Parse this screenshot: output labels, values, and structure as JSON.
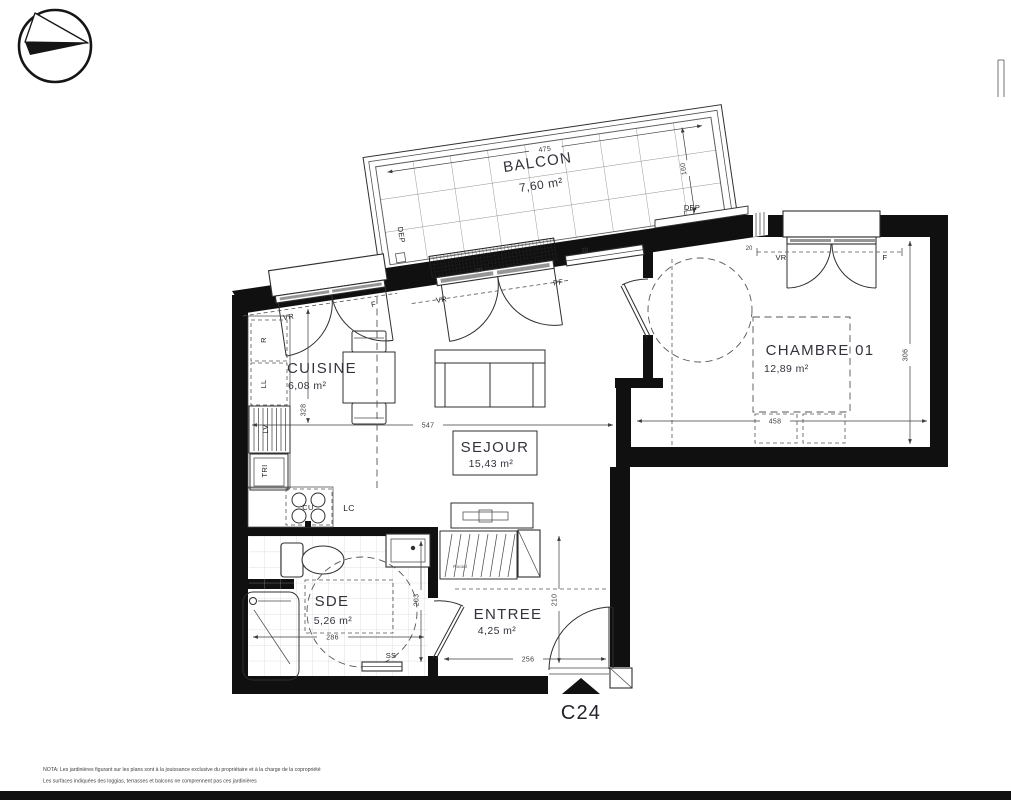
{
  "unit": {
    "id": "C24"
  },
  "rooms": [
    {
      "key": "balcon",
      "name": "BALCON",
      "area": "7,60 m²"
    },
    {
      "key": "cuisine",
      "name": "CUISINE",
      "area": "6,08 m²"
    },
    {
      "key": "sejour",
      "name": "SEJOUR",
      "area": "15,43 m²"
    },
    {
      "key": "chambre",
      "name": "CHAMBRE 01",
      "area": "12,89 m²"
    },
    {
      "key": "sde",
      "name": "SDE",
      "area": "5,26 m²"
    },
    {
      "key": "entree",
      "name": "ENTREE",
      "area": "4,25 m²"
    }
  ],
  "dimensions_cm": {
    "balcony_width": "475",
    "balcony_depth": "160",
    "kitchen_depth": "328",
    "living_width": "547",
    "bedroom_width": "458",
    "bedroom_depth": "306",
    "sde_width": "286",
    "sde_depth": "203",
    "entry_width": "256",
    "entry_depth": "210",
    "wall_offset": "20"
  },
  "equipment_labels": {
    "vr": "VR",
    "f": "F",
    "pf": "PF",
    "dep": "DEP",
    "fridge": "R",
    "washing_machine": "LL",
    "dishwasher": "LV",
    "sorting_bin": "TRI",
    "cooktop": "CU",
    "lc": "LC",
    "towel_radiator": "SS",
    "closet": "Placard"
  },
  "nota": {
    "line1": "NOTA: Les jardinières figurant sur les plans sont à la jouissance exclusive du propriétaire et à la charge de la copropriété",
    "line2": "Les surfaces indiquées des loggias, terrasses et balcons ne comprennent pas ces jardinières"
  },
  "colors": {
    "wall": "#101010",
    "line": "#2f2f2f",
    "dim": "#3c3c3c",
    "tile": "#c2c2c2"
  }
}
